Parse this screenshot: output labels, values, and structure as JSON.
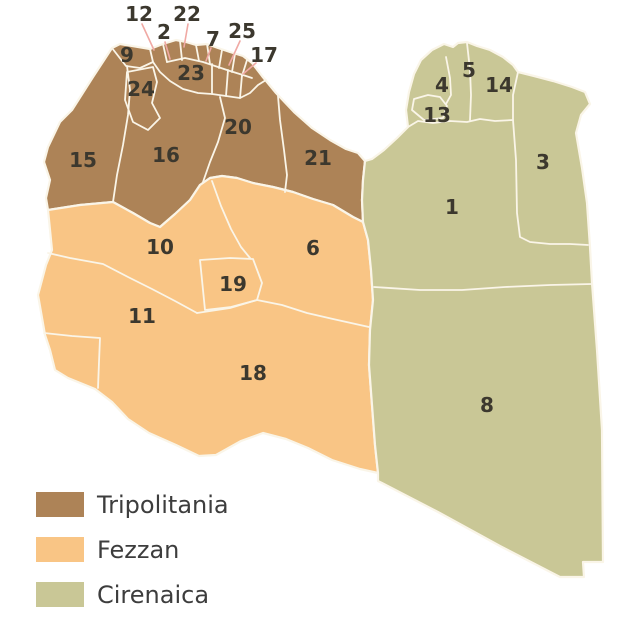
{
  "map": {
    "title": "Districts of Libya by historic region",
    "colors": {
      "tripolitania": "#ad8357",
      "fezzan": "#f9c585",
      "cirenaica": "#c9c796",
      "border": "#faf5e8",
      "sea": "#ffffff",
      "label_text": "#3c382e",
      "leader_line": "#f0a9a4"
    },
    "district_labels": [
      {
        "n": "1",
        "x": 452,
        "y": 207,
        "region": "cirenaica"
      },
      {
        "n": "2",
        "x": 164,
        "y": 32,
        "region": "tripolitania"
      },
      {
        "n": "3",
        "x": 543,
        "y": 162,
        "region": "cirenaica"
      },
      {
        "n": "4",
        "x": 442,
        "y": 85,
        "region": "cirenaica"
      },
      {
        "n": "5",
        "x": 469,
        "y": 70,
        "region": "cirenaica"
      },
      {
        "n": "6",
        "x": 313,
        "y": 248,
        "region": "fezzan"
      },
      {
        "n": "7",
        "x": 213,
        "y": 39,
        "region": "tripolitania"
      },
      {
        "n": "8",
        "x": 487,
        "y": 405,
        "region": "cirenaica"
      },
      {
        "n": "9",
        "x": 127,
        "y": 55,
        "region": "tripolitania"
      },
      {
        "n": "10",
        "x": 160,
        "y": 247,
        "region": "fezzan"
      },
      {
        "n": "11",
        "x": 142,
        "y": 316,
        "region": "fezzan"
      },
      {
        "n": "12",
        "x": 139,
        "y": 14,
        "region": "tripolitania"
      },
      {
        "n": "13",
        "x": 437,
        "y": 115,
        "region": "cirenaica"
      },
      {
        "n": "14",
        "x": 499,
        "y": 85,
        "region": "cirenaica"
      },
      {
        "n": "15",
        "x": 83,
        "y": 160,
        "region": "tripolitania"
      },
      {
        "n": "16",
        "x": 166,
        "y": 155,
        "region": "tripolitania"
      },
      {
        "n": "17",
        "x": 264,
        "y": 55,
        "region": "tripolitania"
      },
      {
        "n": "18",
        "x": 253,
        "y": 373,
        "region": "fezzan"
      },
      {
        "n": "19",
        "x": 233,
        "y": 284,
        "region": "fezzan"
      },
      {
        "n": "20",
        "x": 238,
        "y": 127,
        "region": "tripolitania"
      },
      {
        "n": "21",
        "x": 318,
        "y": 158,
        "region": "tripolitania"
      },
      {
        "n": "22",
        "x": 187,
        "y": 14,
        "region": "tripolitania"
      },
      {
        "n": "23",
        "x": 191,
        "y": 73,
        "region": "tripolitania"
      },
      {
        "n": "24",
        "x": 141,
        "y": 89,
        "region": "tripolitania"
      },
      {
        "n": "25",
        "x": 242,
        "y": 31,
        "region": "tripolitania"
      }
    ],
    "leader_lines": [
      {
        "label": "12",
        "x1": 142,
        "y1": 24,
        "x2": 154,
        "y2": 50
      },
      {
        "label": "2",
        "x1": 165,
        "y1": 42,
        "x2": 170,
        "y2": 59
      },
      {
        "label": "22",
        "x1": 188,
        "y1": 24,
        "x2": 184,
        "y2": 47
      },
      {
        "label": "7",
        "x1": 211,
        "y1": 48,
        "x2": 206,
        "y2": 61
      },
      {
        "label": "25",
        "x1": 240,
        "y1": 41,
        "x2": 229,
        "y2": 65
      },
      {
        "label": "17",
        "x1": 256,
        "y1": 63,
        "x2": 243,
        "y2": 74
      }
    ]
  },
  "legend": {
    "items": [
      {
        "label": "Tripolitania",
        "color": "#ad8357"
      },
      {
        "label": "Fezzan",
        "color": "#f9c585"
      },
      {
        "label": "Cirenaica",
        "color": "#c9c796"
      }
    ]
  }
}
